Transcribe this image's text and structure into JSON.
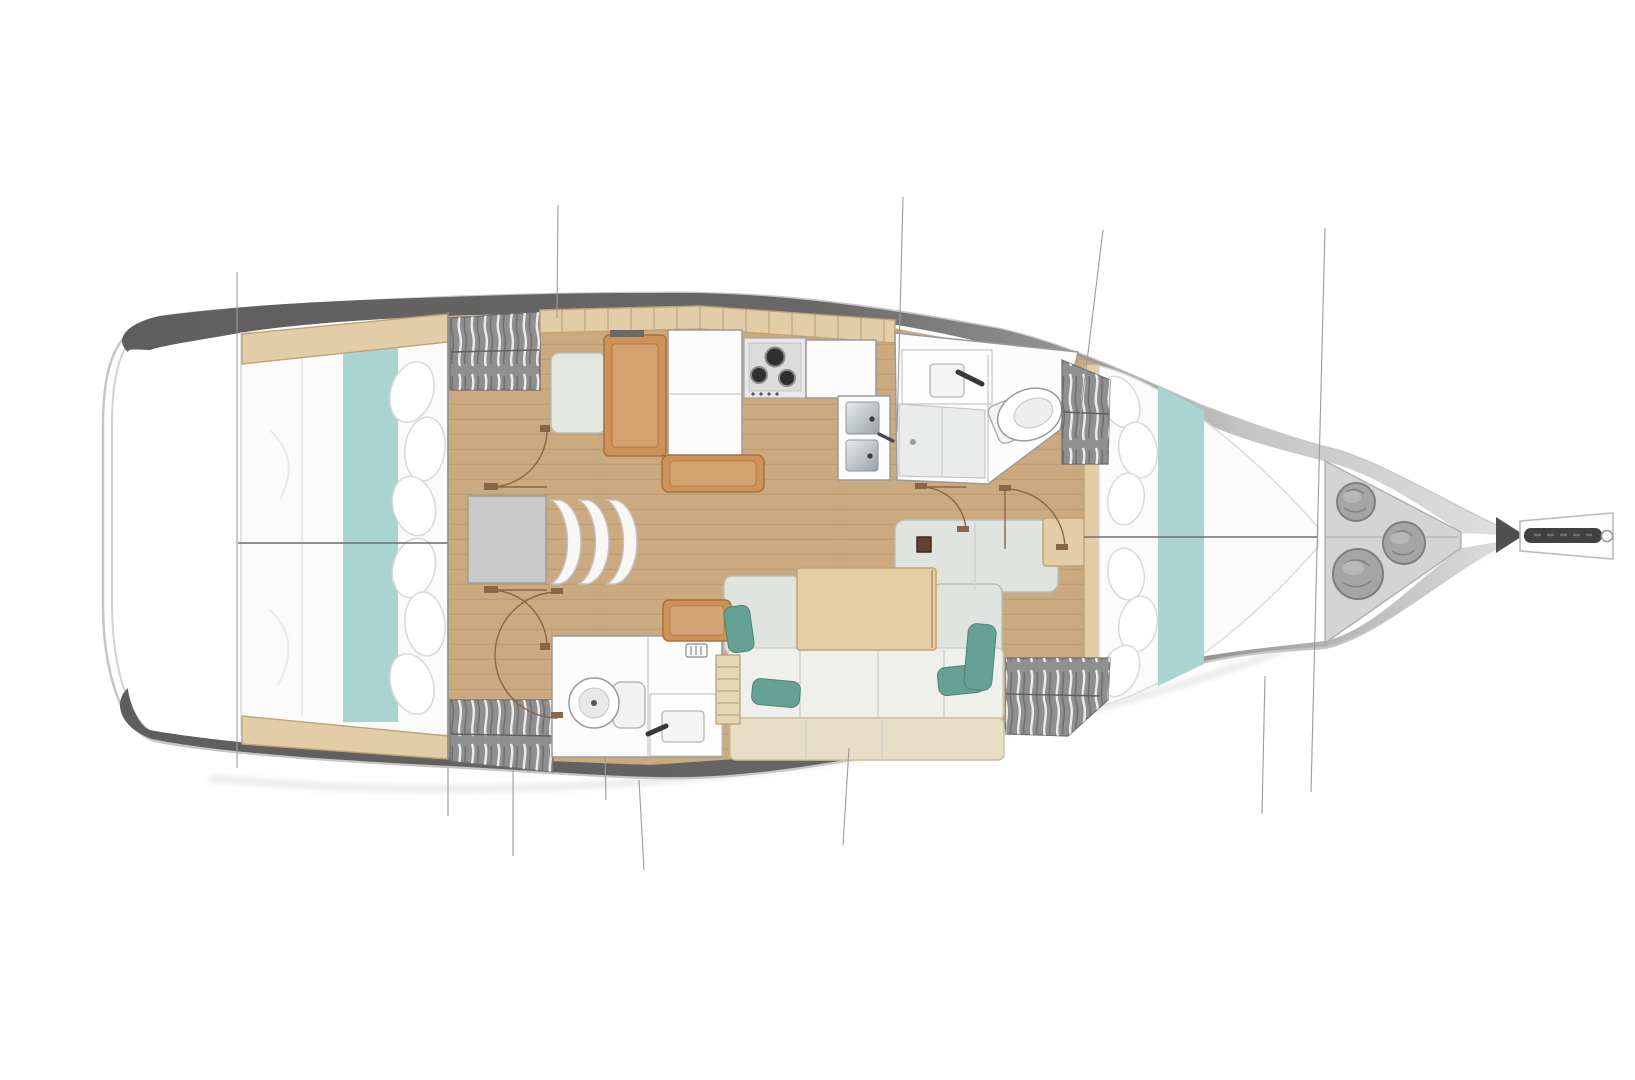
{
  "diagram": {
    "type": "floor-plan",
    "subject": "sailing yacht interior layout, top view, bow pointing right",
    "rooms": [
      {
        "name": "aft-cabin-upper",
        "items": [
          "double berth",
          "teal bed runner",
          "pillows",
          "hanging wardrobe"
        ]
      },
      {
        "name": "aft-cabin-lower",
        "items": [
          "double berth",
          "teal bed runner",
          "pillows",
          "hanging wardrobe"
        ]
      },
      {
        "name": "companionway",
        "items": [
          "landing",
          "3 curved steps"
        ]
      },
      {
        "name": "nav-station",
        "items": [
          "chart table",
          "seat"
        ]
      },
      {
        "name": "galley",
        "items": [
          "overhead locker row",
          "fridge",
          "3-burner stove",
          "counter",
          "double sink",
          "island seat"
        ]
      },
      {
        "name": "forward-head",
        "items": [
          "vanity sink",
          "faucet",
          "toilet",
          "shower pan"
        ]
      },
      {
        "name": "aft-head",
        "items": [
          "toilet",
          "vanity sink",
          "faucet",
          "vent grille"
        ]
      },
      {
        "name": "saloon",
        "items": [
          "L-sofa",
          "dining table",
          "4 teal cushions",
          "chaise seat",
          "forward bench",
          "side table",
          "storage rack",
          "mast base"
        ]
      },
      {
        "name": "forward-cabin",
        "items": [
          "V-berth",
          "teal bed runner",
          "pillows",
          "2 hanging wardrobes"
        ]
      },
      {
        "name": "bow-locker",
        "items": [
          "3 fender bags"
        ]
      },
      {
        "name": "bow",
        "items": [
          "bowsprit",
          "anchor roller"
        ]
      }
    ],
    "counts": {
      "double_berths": 3,
      "heads": 2,
      "stove_burners": 3,
      "galley_sinks": 2,
      "companionway_steps": 3,
      "wardrobes": 4,
      "fender_bags": 3,
      "teal_cushions": 4
    }
  },
  "colors": {
    "hull_band_dark": "#5e5e5e",
    "hull_band_mid": "#8f8f8f",
    "hull_band_light": "#e2e2e2",
    "floor_wood": "#cbaa7f",
    "counter_wood": "#e2cda7",
    "furniture_wood": "#cd9258",
    "bedding_teal": "#a9d4d2",
    "pillow_teal": "#66a294",
    "sofa_back": "#e0e4e0",
    "sofa_seat": "#efefeb",
    "sofa_front": "#e8ddc5",
    "wardrobe_gray": "#8f8f8f",
    "landing_gray": "#c9c9c9",
    "locker_gray": "#d4d4d4",
    "bag_gray": "#a5a5a5",
    "door_arc_brown": "#8a6648",
    "steel_light": "#e9eced",
    "steel_dark": "#9aa1a5"
  }
}
